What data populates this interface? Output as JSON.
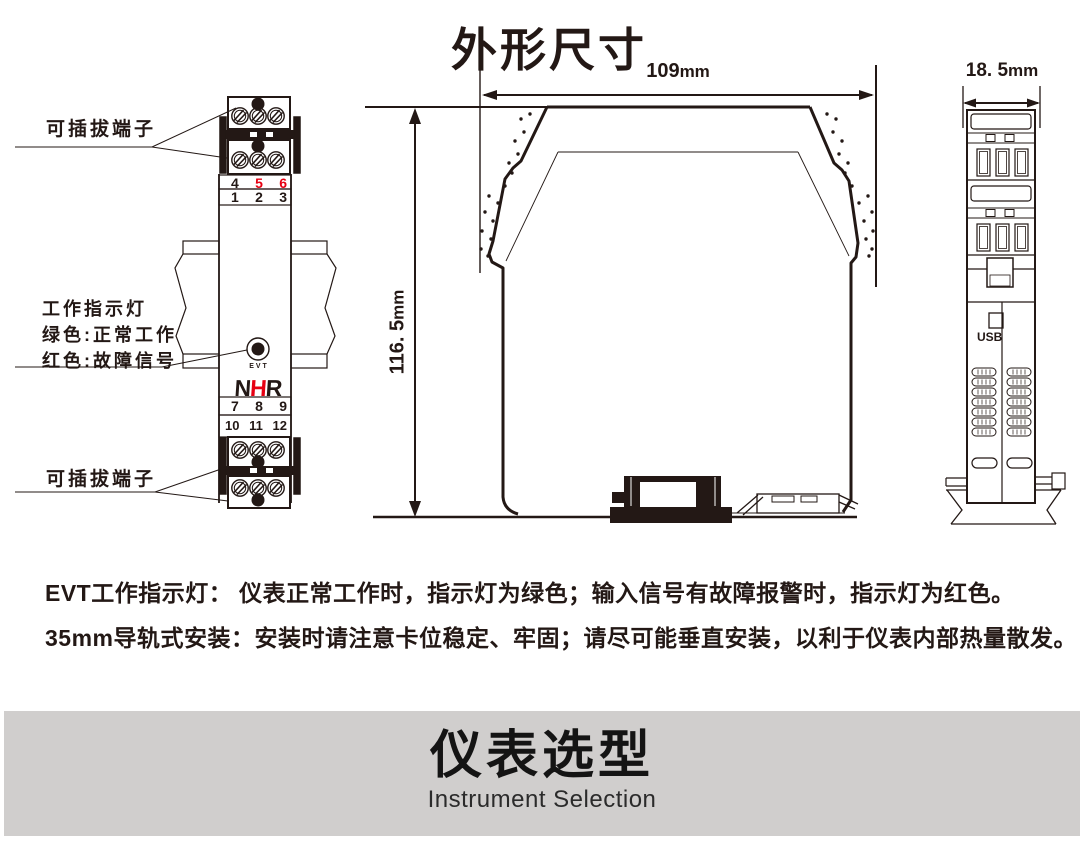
{
  "title": "外形尺寸",
  "front_view": {
    "pluggable_label_top": "可插拔端子",
    "pluggable_label_bottom": "可插拔端子",
    "indicator_label_line1": "工作指示灯",
    "indicator_label_line2": "绿色:正常工作",
    "indicator_label_line3": "红色:故障信号",
    "led_label": "EVT",
    "logo": {
      "part1": "N",
      "part2": "H",
      "part3": "R"
    },
    "terminal_rows": {
      "top_upper": [
        "4",
        "5",
        "6"
      ],
      "top_lower": [
        "1",
        "2",
        "3"
      ],
      "bottom_upper": [
        "7",
        "8",
        "9"
      ],
      "bottom_lower": [
        "10",
        "11",
        "12"
      ]
    }
  },
  "dimensions": {
    "width": "109",
    "height": "116. 5",
    "depth": "18. 5",
    "unit": "mm"
  },
  "side_view": {
    "usb_label": "USB"
  },
  "notes": [
    "EVT工作指示灯： 仪表正常工作时，指示灯为绿色；输入信号有故障报警时，指示灯为红色。",
    "35mm导轨式安装：安装时请注意卡位稳定、牢固；请尽可能垂直安装，以利于仪表内部热量散发。"
  ],
  "banner": {
    "title": "仪表选型",
    "subtitle": "Instrument Selection"
  },
  "colors": {
    "ink": "#231815",
    "accent_red": "#e60012",
    "banner_bg": "#d0cecd"
  }
}
